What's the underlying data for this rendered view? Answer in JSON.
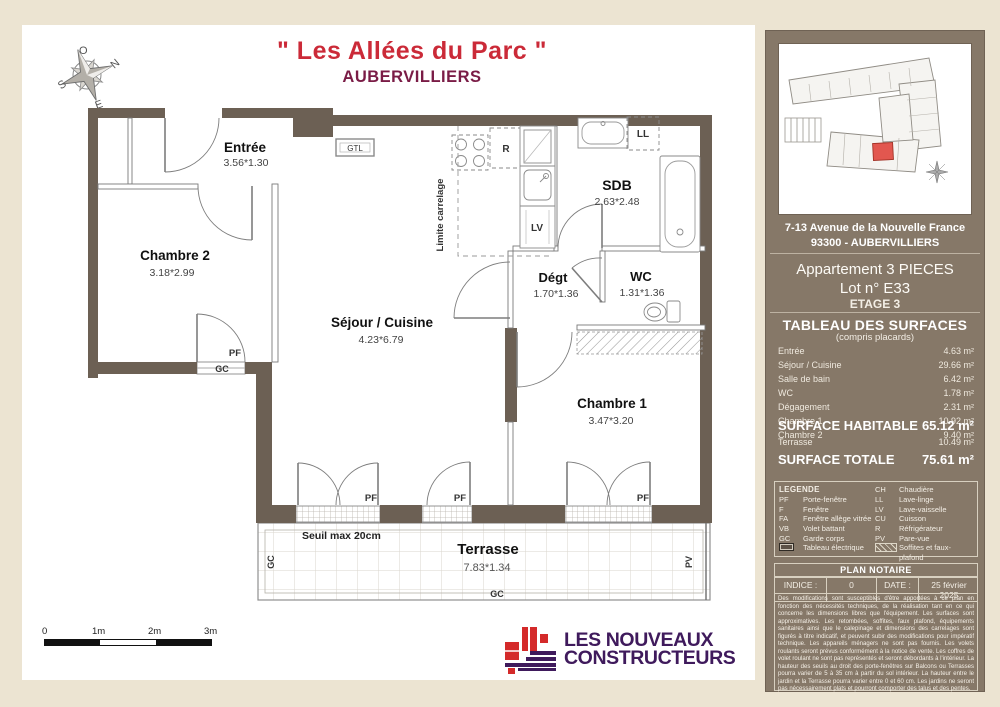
{
  "title": {
    "project": "\" Les Allées du Parc \"",
    "city": "AUBERVILLIERS"
  },
  "compass": {
    "o": "O",
    "n": "N",
    "s": "S",
    "e": "E"
  },
  "plan": {
    "rooms": [
      {
        "name": "Entrée",
        "dims": "3.56*1.30"
      },
      {
        "name": "Chambre 2",
        "dims": "3.18*2.99"
      },
      {
        "name": "Séjour / Cuisine",
        "dims": "4.23*6.79"
      },
      {
        "name": "SDB",
        "dims": "2.63*2.48"
      },
      {
        "name": "Dégt",
        "dims": "1.70*1.36"
      },
      {
        "name": "WC",
        "dims": "1.31*1.36"
      },
      {
        "name": "Chambre 1",
        "dims": "3.47*3.20"
      },
      {
        "name": "Terrasse",
        "dims": "7.83*1.34"
      }
    ],
    "marks": {
      "gtl": "GTL",
      "r": "R",
      "lv": "LV",
      "ll": "LL",
      "pf": "PF",
      "gc": "GC",
      "pv": "PV",
      "limite_carrelage": "Limite carrelage",
      "seuil": "Seuil max 20cm"
    }
  },
  "scalebar": {
    "t0": "0",
    "t1": "1m",
    "t2": "2m",
    "t3": "3m"
  },
  "logo": {
    "line1": "LES NOUVEAUX",
    "line2": "CONSTRUCTEURS"
  },
  "sidebar": {
    "address_line1": "7-13 Avenue de la Nouvelle France",
    "address_line2": "93300 - AUBERVILLIERS",
    "apartment_line1": "Appartement 3 PIECES",
    "apartment_line2": "Lot n° E33",
    "floor": "ETAGE 3",
    "surfaces": {
      "heading": "TABLEAU DES SURFACES",
      "subheading": "(compris placards)",
      "rows": [
        {
          "label": "Entrée",
          "value": "4.63 m²"
        },
        {
          "label": "Séjour / Cuisine",
          "value": "29.66 m²"
        },
        {
          "label": "Salle de bain",
          "value": "6.42 m²"
        },
        {
          "label": "WC",
          "value": "1.78 m²"
        },
        {
          "label": "Dégagement",
          "value": "2.31 m²"
        },
        {
          "label": "Chambre 1",
          "value": "10.92 m²"
        },
        {
          "label": "Chambre 2",
          "value": "9.40 m²"
        }
      ],
      "habitable": {
        "label": "SURFACE HABITABLE",
        "value": "65.12 m²"
      },
      "terrasse": {
        "label": "Terrasse",
        "value": "10.49 m²"
      },
      "totale": {
        "label": "SURFACE TOTALE",
        "value": "75.61 m²"
      }
    },
    "legend": {
      "heading": "LEGENDE",
      "left": [
        {
          "abbr": "PF",
          "label": "Porte-fenêtre"
        },
        {
          "abbr": "F",
          "label": "Fenêtre"
        },
        {
          "abbr": "FA",
          "label": "Fenêtre allège vitrée"
        },
        {
          "abbr": "VB",
          "label": "Volet battant"
        },
        {
          "abbr": "GC",
          "label": "Garde corps"
        },
        {
          "abbr": "",
          "label": "Tableau électrique"
        }
      ],
      "right": [
        {
          "abbr": "CH",
          "label": "Chaudière"
        },
        {
          "abbr": "LL",
          "label": "Lave-linge"
        },
        {
          "abbr": "LV",
          "label": "Lave-vaisselle"
        },
        {
          "abbr": "CU",
          "label": "Cuisson"
        },
        {
          "abbr": "R",
          "label": "Réfrigérateur"
        },
        {
          "abbr": "PV",
          "label": "Pare-vue"
        },
        {
          "abbr": "",
          "label": "Soffites et faux-plafond"
        }
      ]
    },
    "notaire": {
      "heading": "PLAN NOTAIRE",
      "indice_label": "INDICE :",
      "indice_value": "0",
      "date_label": "DATE :",
      "date_value": "25 février 2025"
    },
    "disclaimer": "Des modifications sont susceptibles d'être apportées à ce plan en fonction des nécessités techniques, de la réalisation tant en ce qui concerne les dimensions libres que l'équipement. Les surfaces sont approximatives. Les retombées, soffites, faux plafond, équipements sanitaires ainsi que le calepinage et dimensions des carrelages sont figurés à titre indicatif, et peuvent subir des modifications pour impératif technique. Les appareils ménagers ne sont pas fournis. Les volets roulants seront prévus conformément à la notice de vente. Les coffres de volet roulant ne sont pas représentés et seront débordants à l'intérieur. La hauteur des seuils au droit des porte-fenêtres sur Balcons ou Terrasses pourra varier de 5 à 35 cm à partir du sol intérieur. La hauteur entre le jardin et la Terrasse pourra varier entre 0 et 60 cm. Les jardins ne seront pas nécessairement plats et pourront comporter des talus et des pentes."
  },
  "colors": {
    "accent_red": "#cb2a38",
    "brand_maroon": "#7a1c46",
    "brand_purple": "#3f1a5c",
    "wall": "#6c6054",
    "panel": "#867868",
    "highlight_unit": "#e2574f"
  }
}
